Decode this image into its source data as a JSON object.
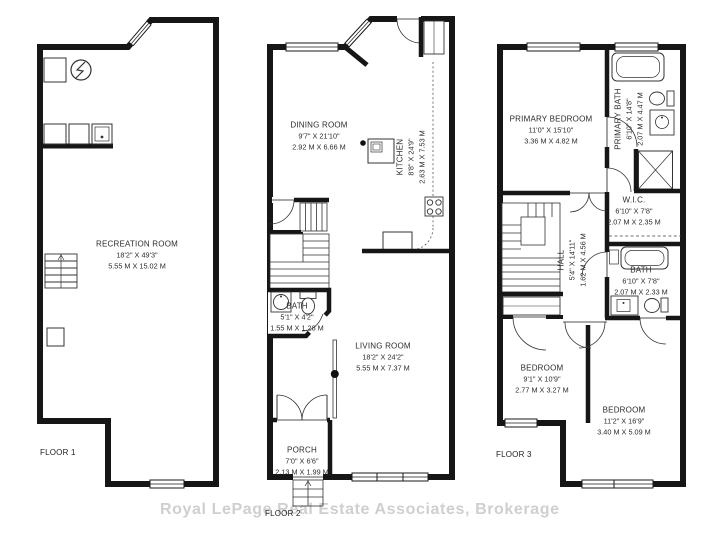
{
  "watermark": "Royal LePage Real Estate Associates, Brokerage",
  "floors": [
    {
      "label": "FLOOR 1",
      "rooms": [
        {
          "name": "RECREATION ROOM",
          "imperial": "18'2\" X 49'3\"",
          "metric": "5.55 M X 15.02 M"
        }
      ]
    },
    {
      "label": "FLOOR 2",
      "rooms": [
        {
          "name": "DINING ROOM",
          "imperial": "9'7\" X 21'10\"",
          "metric": "2.92 M X 6.66 M"
        },
        {
          "name": "KITCHEN",
          "imperial": "8'8\" X 24'9\"",
          "metric": "2.63 M X 7.53 M"
        },
        {
          "name": "BATH",
          "imperial": "5'1\" X 4'2\"",
          "metric": "1.55 M X 1.28 M"
        },
        {
          "name": "LIVING ROOM",
          "imperial": "18'2\" X 24'2\"",
          "metric": "5.55 M X 7.37 M"
        },
        {
          "name": "PORCH",
          "imperial": "7'0\" X 6'6\"",
          "metric": "2.13 M X 1.99 M"
        }
      ]
    },
    {
      "label": "FLOOR 3",
      "rooms": [
        {
          "name": "PRIMARY BEDROOM",
          "imperial": "11'0\" X 15'10\"",
          "metric": "3.36 M X 4.82 M"
        },
        {
          "name": "PRIMARY BATH",
          "imperial": "6'10\" X 14'8\"",
          "metric": "2.07 M X 4.47 M"
        },
        {
          "name": "W.I.C.",
          "imperial": "6'10\" X 7'8\"",
          "metric": "2.07 M X 2.35 M"
        },
        {
          "name": "HALL",
          "imperial": "5'4\" X 14'11\"",
          "metric": "1.62 M X 4.56 M"
        },
        {
          "name": "BATH",
          "imperial": "6'10\" X 7'8\"",
          "metric": "2.07 M X 2.33 M"
        },
        {
          "name": "BEDROOM",
          "imperial": "9'1\" X 10'9\"",
          "metric": "2.77 M X 3.27 M"
        },
        {
          "name": "BEDROOM",
          "imperial": "11'2\" X 16'9\"",
          "metric": "3.40 M X 5.09 M"
        }
      ]
    }
  ]
}
